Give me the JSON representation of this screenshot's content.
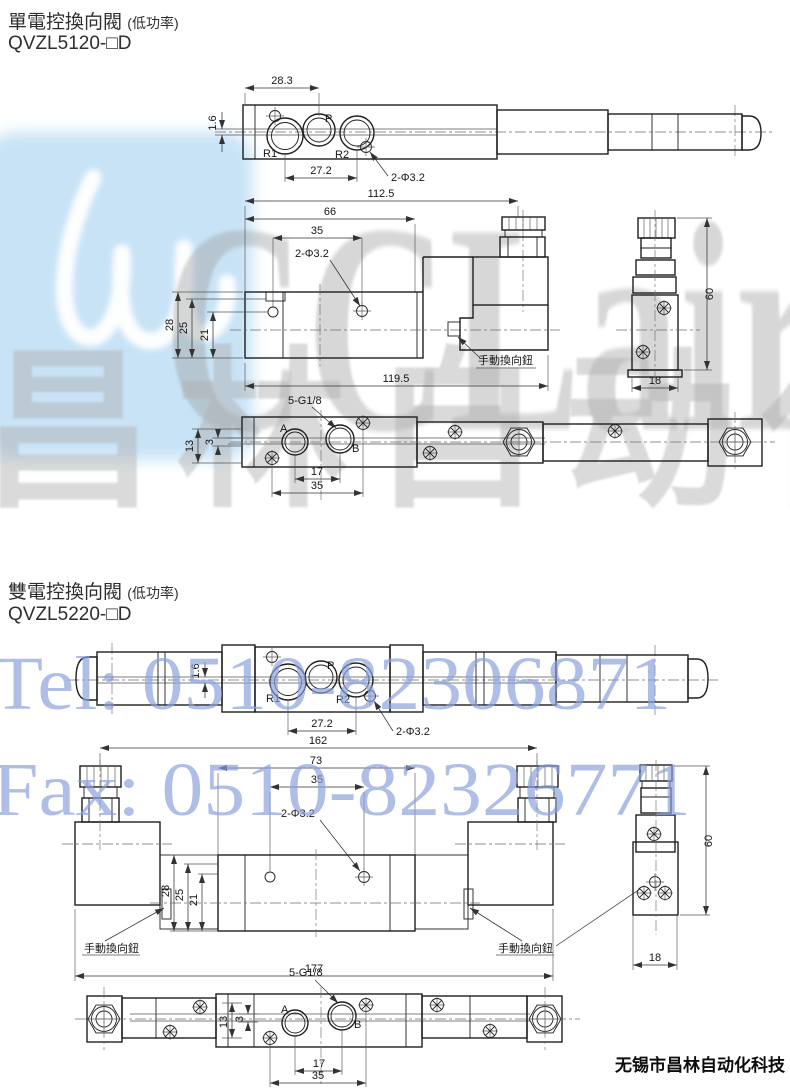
{
  "watermark": {
    "logo_text": "CCLair",
    "brand_cn": "昌林自动化",
    "tel": "Tel: 0510-82306871",
    "fax": "Fax: 0510-82326771"
  },
  "footer": {
    "company": "无锡市昌林自动化科技"
  },
  "sections": [
    {
      "title": "單電控換向閥",
      "title_note": "(低功率)",
      "model": "QVZL5120-□D",
      "top_view": {
        "dim_left_to_p": "28.3",
        "dim_offset": "1.6",
        "dim_r1_r2": "27.2",
        "holes_label": "2-Φ3.2",
        "port_r1": "R1",
        "port_p": "P",
        "port_r2": "R2"
      },
      "front_view": {
        "dim_total_top": "112.5",
        "dim_body": "66",
        "dim_holes": "35",
        "holes_label": "2-Φ3.2",
        "dim_h28": "28",
        "dim_h25": "25",
        "dim_h21": "21",
        "dim_overall": "119.5",
        "manual_label": "手動換向鈕"
      },
      "side_view": {
        "dim_height": "60",
        "dim_width": "18"
      },
      "bottom_view": {
        "thread_label": "5-G1/8",
        "dim_h13": "13",
        "dim_h3": "3",
        "port_a": "A",
        "port_b": "B",
        "dim_ab": "17",
        "dim_screws": "35"
      }
    },
    {
      "title": "雙電控換向閥",
      "title_note": "(低功率)",
      "model": "QVZL5220-□D",
      "top_view": {
        "dim_offset": "1.6",
        "dim_r1_r2": "27.2",
        "holes_label": "2-Φ3.2",
        "port_r1": "R1",
        "port_p": "P",
        "port_r2": "R2"
      },
      "front_view": {
        "dim_total_top": "162",
        "dim_body": "73",
        "dim_holes": "35",
        "holes_label": "2-Φ3.2",
        "dim_h28": "28",
        "dim_h25": "25",
        "dim_h21": "21",
        "dim_overall": "177",
        "manual_label_left": "手動換向鈕",
        "manual_label_right": "手動換向鈕"
      },
      "side_view": {
        "dim_height": "60",
        "dim_width": "18"
      },
      "bottom_view": {
        "thread_label": "5-G1/8",
        "dim_h13": "13",
        "dim_h3": "3",
        "port_a": "A",
        "port_b": "B",
        "dim_ab": "17",
        "dim_screws": "35"
      }
    }
  ]
}
